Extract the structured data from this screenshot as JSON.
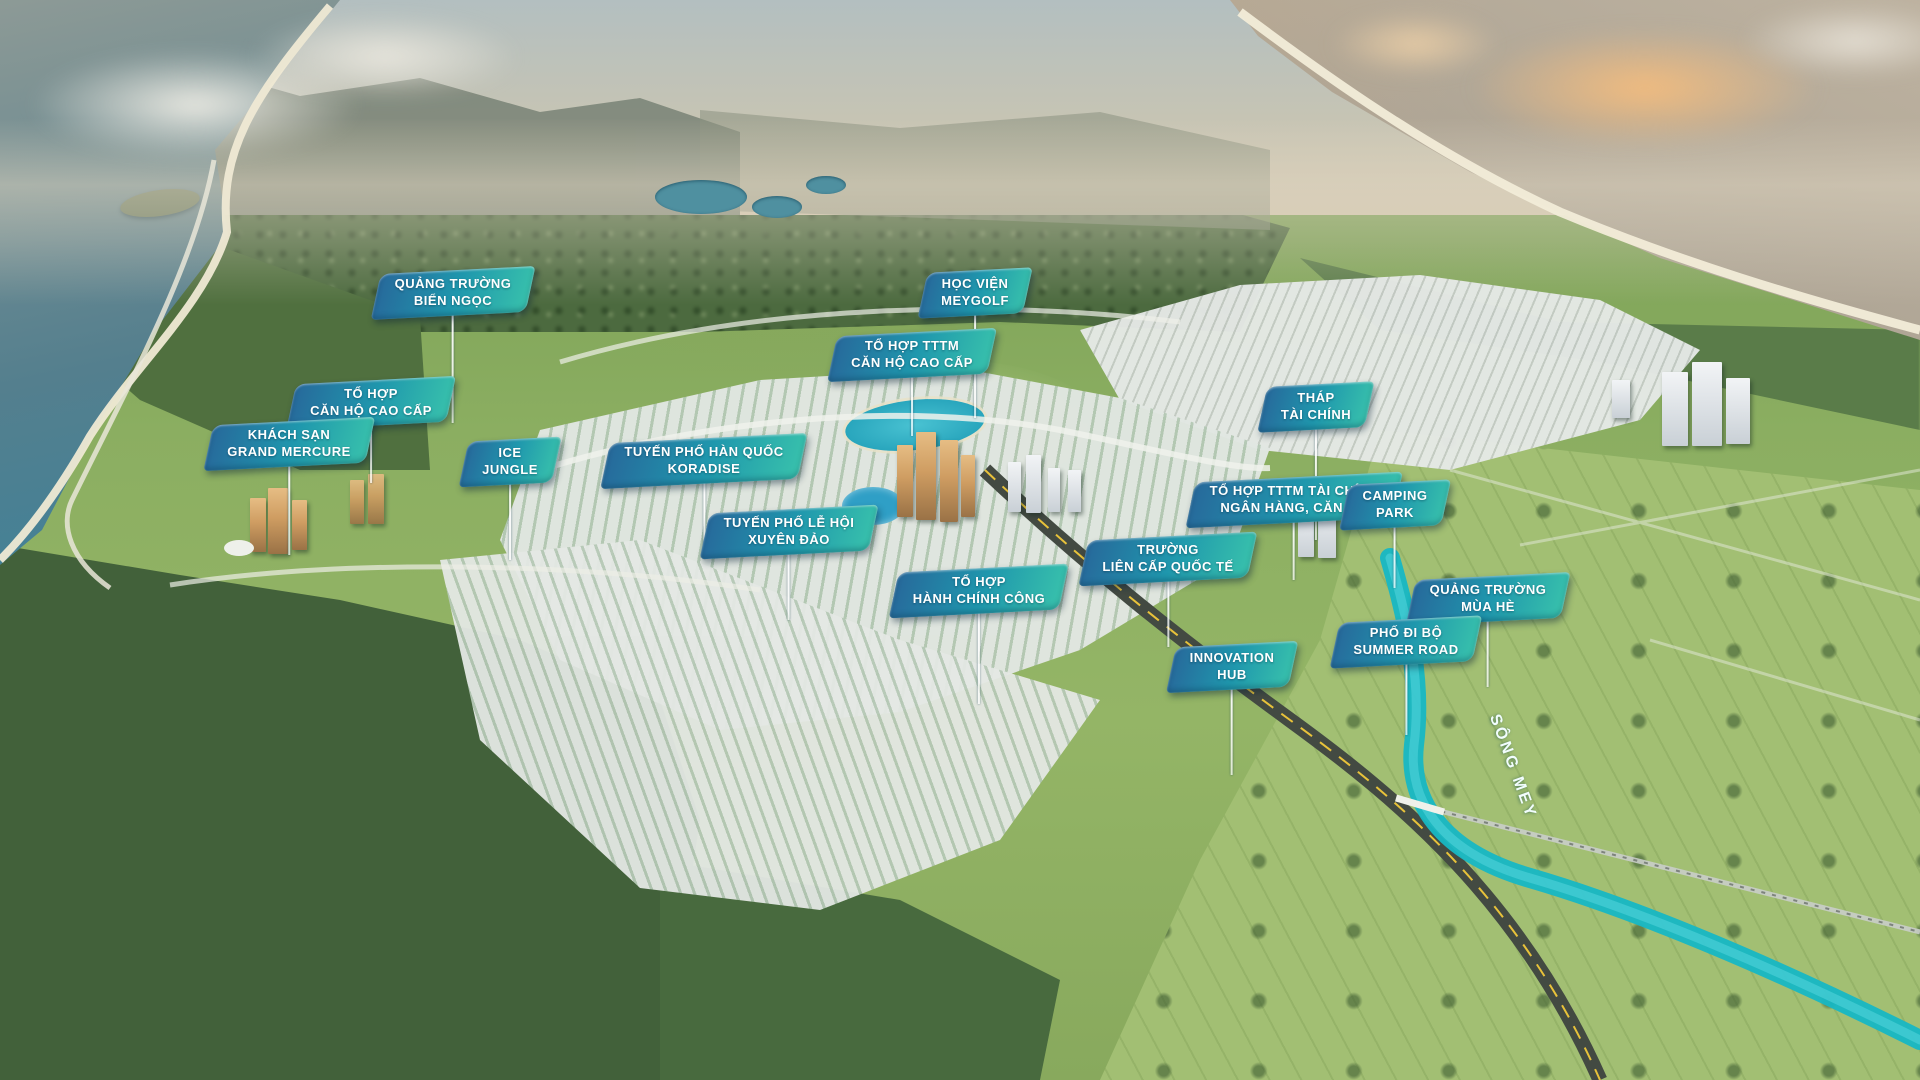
{
  "scene": {
    "type": "aerial-masterplan-render",
    "river_label": "SÔNG MEY",
    "colors": {
      "flag_gradient_start": "#27699b",
      "flag_gradient_mid": "#1f97ad",
      "flag_gradient_end": "#38c1ac",
      "flag_text": "#ffffff",
      "leader_line": "#f2fbfa",
      "river": "#17b7c4",
      "lagoon": "#29a6bd",
      "sea_left": "#2f84a0",
      "sunset_cloud": "#f3bc7e",
      "forest_dark": "#47653c",
      "meadow_light": "#a2bf73",
      "city_light": "#e4e8e4",
      "tower_gold": "#cf9d62"
    }
  },
  "labels": [
    {
      "id": "quang-truong-bien-ngoc",
      "lines": [
        "QUẢNG TRƯỜNG",
        "BIỂN NGỌC"
      ],
      "x": 453,
      "y": 291,
      "leader": 109
    },
    {
      "id": "hoc-vien-meygolf",
      "lines": [
        "HỌC VIỆN",
        "MEYGOLF"
      ],
      "x": 975,
      "y": 291,
      "leader": 104
    },
    {
      "id": "to-hop-tttm-can-ho-cao-cap",
      "lines": [
        "TỔ HỢP TTTM",
        "CĂN HỘ CAO CẤP"
      ],
      "x": 912,
      "y": 353,
      "leader": 60
    },
    {
      "id": "to-hop-can-ho-cao-cap",
      "lines": [
        "TỔ HỢP",
        "CĂN HỘ CAO CẤP"
      ],
      "x": 371,
      "y": 401,
      "leader": 59
    },
    {
      "id": "khach-san-grand-mercure",
      "lines": [
        "KHÁCH SẠN",
        "GRAND MERCURE"
      ],
      "x": 289,
      "y": 442,
      "leader": 90
    },
    {
      "id": "ice-jungle",
      "lines": [
        "ICE",
        "JUNGLE"
      ],
      "x": 510,
      "y": 460,
      "leader": 77
    },
    {
      "id": "tuyen-pho-han-quoc-koradise",
      "lines": [
        "TUYẾN PHỐ HÀN QUỐC",
        "KORADISE"
      ],
      "x": 704,
      "y": 459,
      "leader": 77
    },
    {
      "id": "tuyen-pho-le-hoi-xuyen-dao",
      "lines": [
        "TUYẾN PHỐ LỄ HỘI",
        "XUYÊN ĐẢO"
      ],
      "x": 789,
      "y": 530,
      "leader": 67
    },
    {
      "id": "to-hop-hanh-chinh-cong",
      "lines": [
        "TỔ HỢP",
        "HÀNH CHÍNH CÔNG"
      ],
      "x": 979,
      "y": 589,
      "leader": 92
    },
    {
      "id": "truong-lien-cap-quoc-te",
      "lines": [
        "TRƯỜNG",
        "LIÊN CẤP QUỐC TẾ"
      ],
      "x": 1168,
      "y": 557,
      "leader": 67
    },
    {
      "id": "innovation-hub",
      "lines": [
        "INNOVATION",
        "HUB"
      ],
      "x": 1232,
      "y": 665,
      "leader": 87
    },
    {
      "id": "thap-tai-chinh",
      "lines": [
        "THÁP",
        "TÀI CHÍNH"
      ],
      "x": 1316,
      "y": 405,
      "leader": 112
    },
    {
      "id": "to-hop-tttm-tai-chinh-ngan-hang-can-ho",
      "lines": [
        "TỔ HỢP TTTM TÀI CHÍNH",
        "NGÂN HÀNG, CĂN HỘ"
      ],
      "x": 1294,
      "y": 498,
      "leader": 59
    },
    {
      "id": "camping-park",
      "lines": [
        "CAMPING",
        "PARK"
      ],
      "x": 1395,
      "y": 503,
      "leader": 62
    },
    {
      "id": "quang-truong-mua-he",
      "lines": [
        "QUẢNG TRƯỜNG",
        "MÙA HÈ"
      ],
      "x": 1488,
      "y": 597,
      "leader": 67
    },
    {
      "id": "pho-di-bo-summer-road",
      "lines": [
        "PHỐ ĐI BỘ",
        "SUMMER ROAD"
      ],
      "x": 1406,
      "y": 640,
      "leader": 72
    }
  ]
}
